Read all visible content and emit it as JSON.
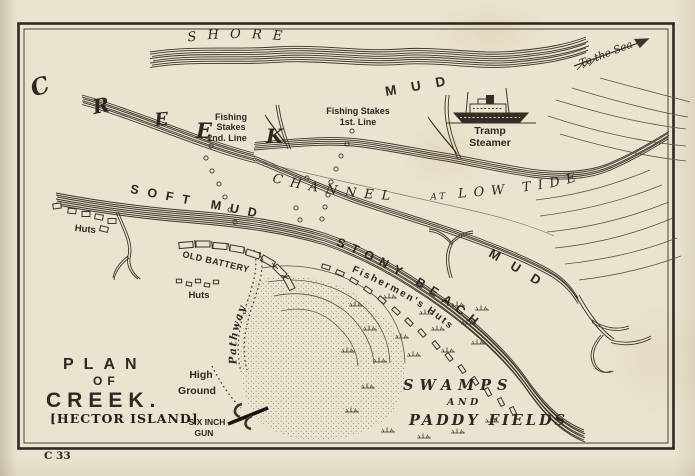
{
  "map": {
    "title": {
      "line1": "PLAN",
      "line2": "OF",
      "line3": "CREEK.",
      "line4": "[HECTOR ISLAND]"
    },
    "plate_number": "C 33",
    "labels": {
      "shore": "SHORE",
      "creek_letters": [
        "C",
        "R",
        "E",
        "E",
        "K"
      ],
      "mud_top": "MUD",
      "mud_right": "MUD",
      "to_the_sea": "To the Sea",
      "tramp_steamer": [
        "Tramp",
        "Steamer"
      ],
      "fishing_stakes_second": [
        "Fishing",
        "Stakes",
        "2nd. Line"
      ],
      "fishing_stakes_first": [
        "Fishing Stakes",
        "1st. Line"
      ],
      "channel": [
        "CHANNEL",
        "AT",
        "LOW TIDE"
      ],
      "soft_mud": "SOFT MUD",
      "huts_left": "Huts",
      "old_battery": "OLD BATTERY",
      "huts_mid": "Huts",
      "pathway": "Pathway",
      "stony_beach": "STONY BEACH",
      "fishermens_huts": "Fishermen's Huts",
      "swamps": [
        "SWAMPS",
        "AND",
        "PADDY FIELDS"
      ],
      "high_ground": [
        "High",
        "Ground"
      ],
      "six_inch_gun": [
        "SIX INCH",
        "GUN"
      ]
    },
    "colors": {
      "paper": "#e9e3cf",
      "ink": "#3c352a",
      "title_ink": "#231d15"
    }
  }
}
